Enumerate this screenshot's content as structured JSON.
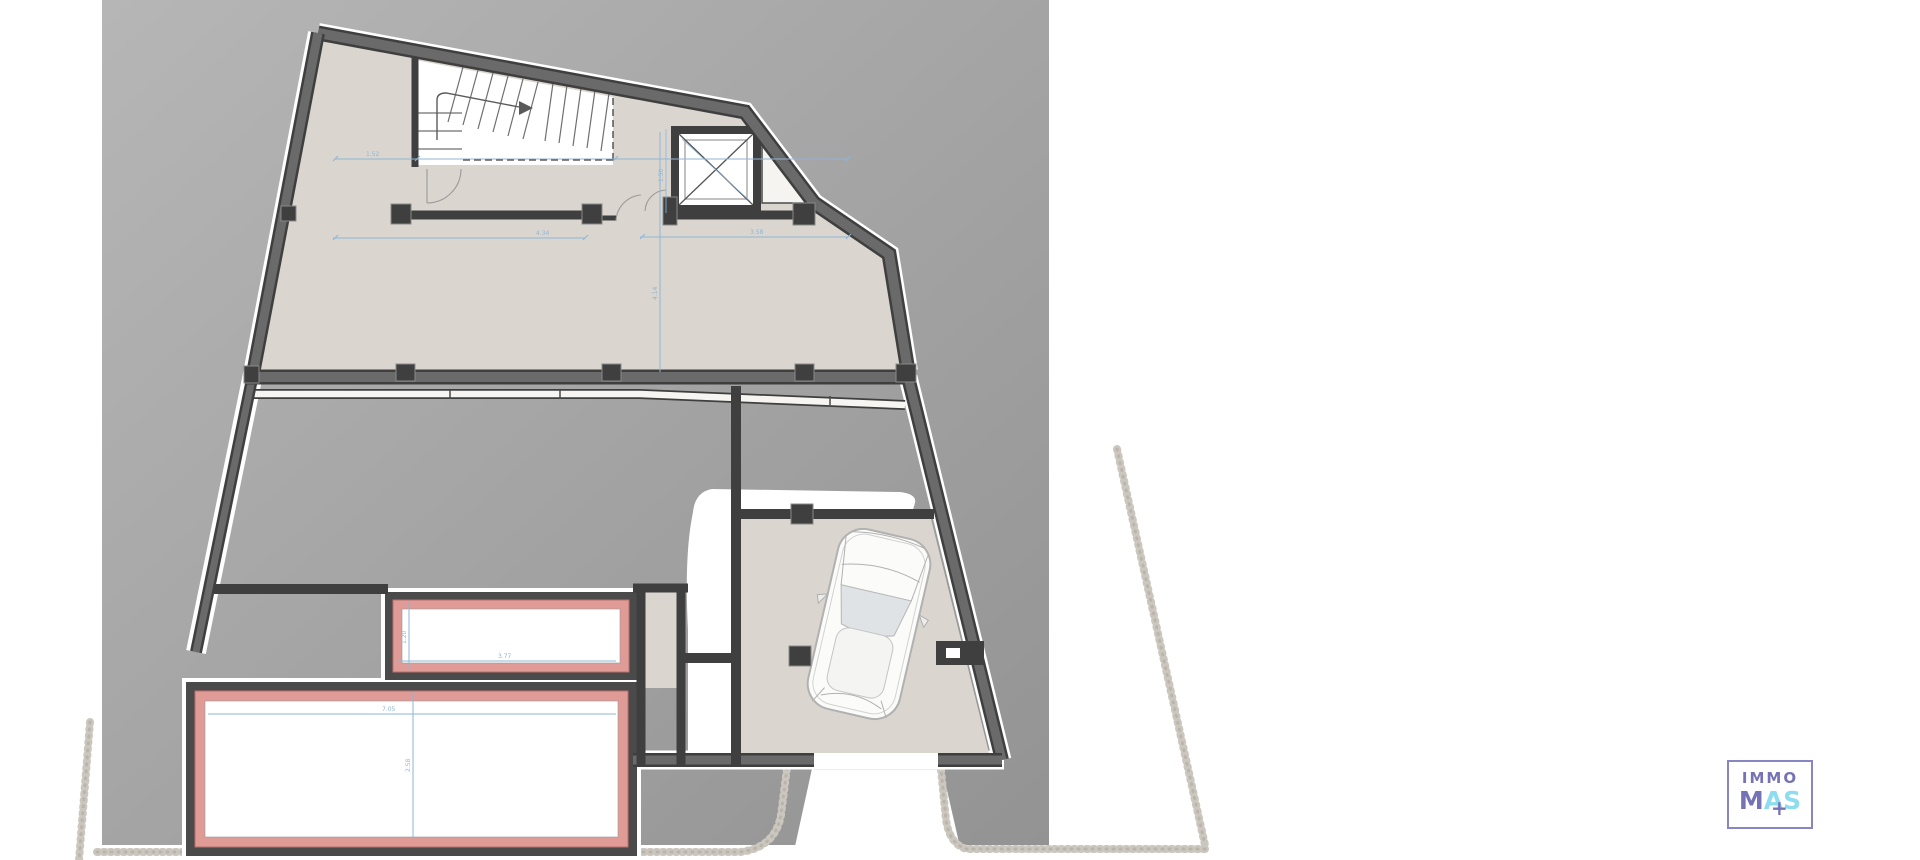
{
  "document": {
    "kind": "architectural floor plan, basement / garage level with pool"
  },
  "colors": {
    "backdrop-top": "#b4b4b4",
    "backdrop-bottom": "#959595",
    "floor": "#dad6cf",
    "wall-dark": "#3f3f3f",
    "wall-mid": "#6a6a6a",
    "pool": "#e09b96",
    "pool-edge": "#b9706c",
    "dim": "#8fb5d6",
    "stipple": "#cbc7bf",
    "carline": "#b1b1b1",
    "glass": "#dfe3e6",
    "logo-purple": "#7573b5",
    "logo-cyan": "#8ddcef",
    "logo-border": "#8886c2"
  },
  "dimensions": {
    "upper_left": "1.52",
    "upper_span": "4.34",
    "upper_right": "3.58",
    "vertical_main": "4.14",
    "elevator_w": "1.50",
    "pool_small_w": "3.77",
    "pool_small_h": "1.20",
    "pool_big_w": "7.05",
    "pool_big_h": "2.58"
  },
  "logo": {
    "line1": "IMMO",
    "m": "M",
    "a": "A",
    "s": "S",
    "plus": "+"
  }
}
